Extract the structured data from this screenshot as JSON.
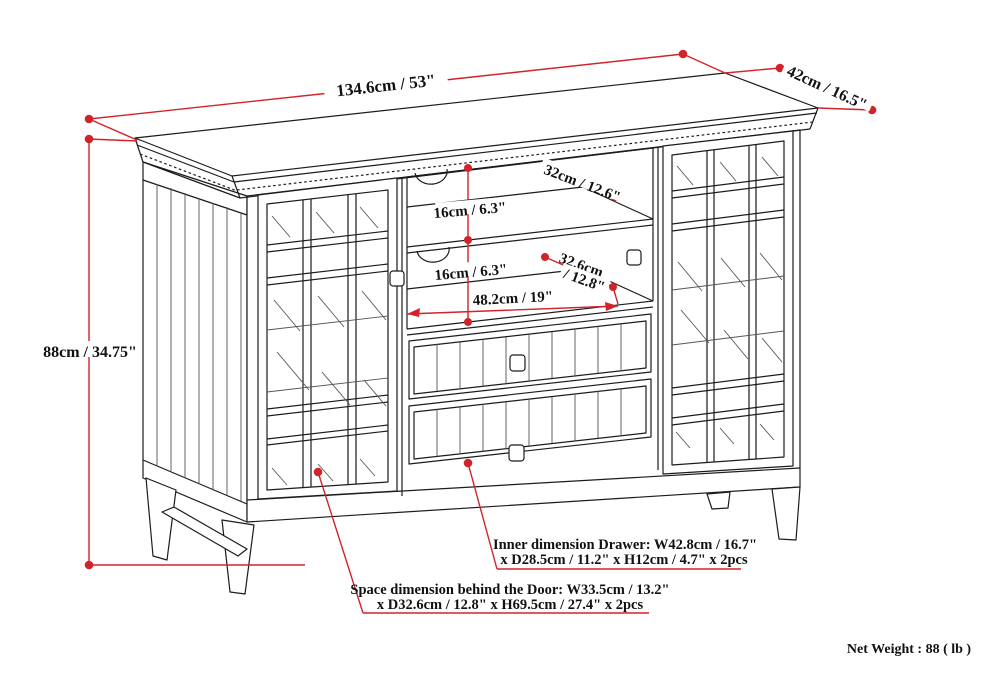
{
  "diagram": {
    "background": "#ffffff",
    "line_color": "#1c1c1c",
    "annotation_color": "#d3232a",
    "dimensions": {
      "overall_width": "134.6cm / 53\"",
      "overall_depth": "42cm / 16.5\"",
      "overall_height": "88cm / 34.75\"",
      "top_shelf_depth": "32cm / 12.6\"",
      "shelf_spacing_upper": "16cm / 6.3\"",
      "shelf_spacing_lower": "16cm / 6.3\"",
      "lower_shelf_depth_line1": "32.6cm",
      "lower_shelf_depth_line2": "/ 12.8\"",
      "center_opening_width": "48.2cm / 19\""
    },
    "notes": {
      "drawer_inner_line1": "Inner dimension Drawer: W42.8cm / 16.7\"",
      "drawer_inner_line2": "x D28.5cm / 11.2\" x H12cm / 4.7\" x 2pcs",
      "door_space_line1": "Space dimension behind the Door: W33.5cm / 13.2\"",
      "door_space_line2": "x D32.6cm / 12.8\" x H69.5cm / 27.4\" x 2pcs",
      "net_weight": "Net Weight : 88 ( lb )"
    }
  }
}
